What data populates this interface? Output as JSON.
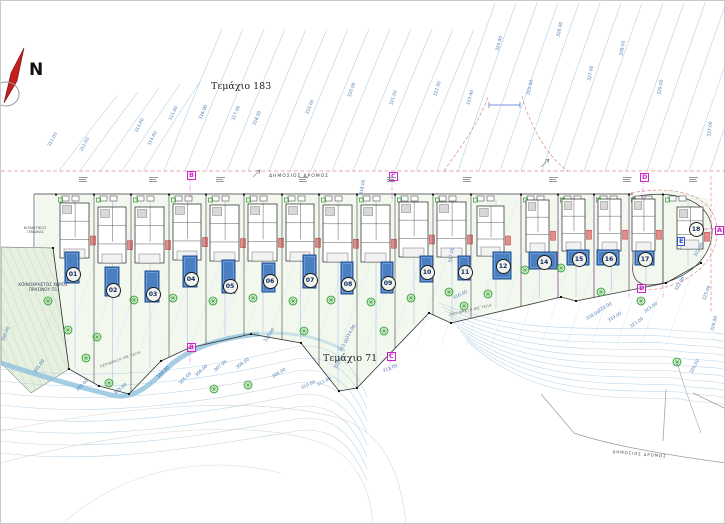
{
  "north_label": "N",
  "parcels": {
    "top": "Τεμάχιο 183",
    "bottom": "Τεμάχιο 71"
  },
  "roads": {
    "top": "ΔΗΜΟΣΙΟΣ ΔΡΟΜΟΣ",
    "bottom_right": "ΔΗΜΟΣΙΟΣ ΔΡΟΜΟΣ"
  },
  "notes": {
    "green_space_line1": "ΚΟΙΝΟΧΡΗΣΤΟΣ ΧΩΡΟΣ",
    "green_space_line2": "ΠΡΑΣΙΝΟΥ Π1",
    "hotel_line1": "ΚΟΙΝΟΤΙΚΟΣ",
    "hotel_line2": "ΞΕΝΩΝΑΣ"
  },
  "fence_labels": [
    {
      "text": "ΠΕΡΙΦΡΑΞΗ ΜΕ ΤΕΛΗ",
      "x": 120,
      "y": 366,
      "r": -20
    },
    {
      "text": "ΠΕΡΙΦΡΑΞΗ ΜΕ ΤΕΛΗ",
      "x": 470,
      "y": 314,
      "r": -13
    }
  ],
  "section_markers": [
    {
      "t": "B",
      "x": 186,
      "y": 170,
      "c": "#cc22cc"
    },
    {
      "t": "C",
      "x": 388,
      "y": 171,
      "c": "#cc22cc"
    },
    {
      "t": "D",
      "x": 639,
      "y": 172,
      "c": "#cc22cc"
    },
    {
      "t": "A",
      "x": 714,
      "y": 225,
      "c": "#cc22cc"
    },
    {
      "t": "E",
      "x": 676,
      "y": 236,
      "c": "#3355cc"
    },
    {
      "t": "D",
      "x": 636,
      "y": 283,
      "c": "#cc22cc"
    },
    {
      "t": "B",
      "x": 186,
      "y": 342,
      "c": "#cc22cc"
    },
    {
      "t": "C",
      "x": 386,
      "y": 351,
      "c": "#cc22cc"
    }
  ],
  "contour_labels": [
    [
      "311.00",
      54,
      147,
      -62
    ],
    [
      "312.00",
      86,
      152,
      -62
    ],
    [
      "313.00",
      141,
      133,
      -63
    ],
    [
      "314.00",
      154,
      146,
      -63
    ],
    [
      "315.00",
      175,
      121,
      -64
    ],
    [
      "316.00",
      205,
      120,
      -66
    ],
    [
      "317.00",
      238,
      121,
      -67
    ],
    [
      "318.00",
      259,
      126,
      -67
    ],
    [
      "319.00",
      312,
      115,
      -68
    ],
    [
      "320.00",
      354,
      98,
      -70
    ],
    [
      "321.00",
      396,
      106,
      -72
    ],
    [
      "322.00",
      440,
      97,
      -73
    ],
    [
      "323.00",
      473,
      106,
      -74
    ],
    [
      "324.00",
      502,
      52,
      -75
    ],
    [
      "325.00",
      533,
      96,
      -76
    ],
    [
      "326.00",
      563,
      38,
      -78
    ],
    [
      "327.00",
      594,
      82,
      -79
    ],
    [
      "328.00",
      626,
      57,
      -80
    ],
    [
      "329.00",
      664,
      96,
      -80
    ],
    [
      "327.00",
      714,
      138,
      -84
    ],
    [
      "318.00",
      366,
      196,
      -80
    ],
    [
      "317.00",
      455,
      264,
      -80
    ],
    [
      "310.00",
      270,
      342,
      -55
    ],
    [
      "310.00",
      307,
      388,
      -25
    ],
    [
      "311.00",
      323,
      385,
      -27
    ],
    [
      "311.00",
      389,
      371,
      -22
    ],
    [
      "312.00",
      340,
      369,
      -55
    ],
    [
      "313.00",
      345,
      352,
      -58
    ],
    [
      "314.00",
      352,
      339,
      -60
    ],
    [
      "304.00",
      163,
      378,
      -45
    ],
    [
      "305.00",
      185,
      384,
      -44
    ],
    [
      "306.00",
      201,
      376,
      -42
    ],
    [
      "307.00",
      220,
      371,
      -40
    ],
    [
      "308.00",
      242,
      368,
      -36
    ],
    [
      "309.00",
      278,
      377,
      -31
    ],
    [
      "300.00",
      8,
      342,
      -70
    ],
    [
      "301.00",
      40,
      373,
      -55
    ],
    [
      "302.00",
      82,
      391,
      -45
    ],
    [
      "303.00",
      120,
      394,
      -40
    ],
    [
      "316.00",
      459,
      298,
      -25
    ],
    [
      "318.00",
      592,
      319,
      -30
    ],
    [
      "319.00",
      614,
      321,
      -32
    ],
    [
      "320.00",
      604,
      311,
      -30
    ],
    [
      "321.00",
      636,
      327,
      -35
    ],
    [
      "323.00",
      650,
      312,
      -35
    ],
    [
      "322.00",
      681,
      291,
      -60
    ],
    [
      "325.00",
      709,
      301,
      -70
    ],
    [
      "320.00",
      696,
      374,
      -62
    ],
    [
      "326.00",
      717,
      332,
      -75
    ],
    [
      "322.00",
      700,
      257,
      -60
    ]
  ],
  "plots": [
    {
      "n": "01",
      "x0": 55,
      "x1": 93,
      "house": [
        59,
        202,
        29,
        55
      ],
      "pool": [
        64,
        251,
        14,
        31
      ],
      "circle": [
        71,
        272
      ]
    },
    {
      "n": "02",
      "x0": 93,
      "x1": 130,
      "house": [
        97,
        206,
        28,
        56
      ],
      "pool": [
        104,
        266,
        14,
        29
      ],
      "circle": [
        111,
        288
      ]
    },
    {
      "n": "03",
      "x0": 130,
      "x1": 168,
      "house": [
        134,
        206,
        29,
        56
      ],
      "pool": [
        144,
        270,
        14,
        31
      ],
      "circle": [
        151,
        292
      ]
    },
    {
      "n": "04",
      "x0": 168,
      "x1": 205,
      "house": [
        172,
        203,
        28,
        56
      ],
      "pool": [
        182,
        255,
        14,
        31
      ],
      "circle": [
        189,
        277
      ]
    },
    {
      "n": "05",
      "x0": 205,
      "x1": 243,
      "house": [
        209,
        204,
        29,
        56
      ],
      "pool": [
        221,
        259,
        13,
        33
      ],
      "circle": [
        228,
        284
      ]
    },
    {
      "n": "06",
      "x0": 243,
      "x1": 281,
      "house": [
        247,
        203,
        29,
        57
      ],
      "pool": [
        261,
        262,
        13,
        29
      ],
      "circle": [
        268,
        279
      ]
    },
    {
      "n": "07",
      "x0": 281,
      "x1": 318,
      "house": [
        285,
        203,
        28,
        57
      ],
      "pool": [
        302,
        254,
        13,
        33
      ],
      "circle": [
        308,
        278
      ]
    },
    {
      "n": "08",
      "x0": 318,
      "x1": 356,
      "house": [
        322,
        204,
        29,
        57
      ],
      "pool": [
        340,
        261,
        12,
        32
      ],
      "circle": [
        346,
        282
      ]
    },
    {
      "n": "09",
      "x0": 356,
      "x1": 394,
      "house": [
        360,
        204,
        29,
        57
      ],
      "pool": [
        380,
        261,
        12,
        31
      ],
      "circle": [
        386,
        281
      ]
    },
    {
      "n": "10",
      "x0": 394,
      "x1": 432,
      "house": [
        398,
        201,
        29,
        55
      ],
      "pool": [
        419,
        255,
        13,
        26
      ],
      "circle": [
        425,
        270
      ]
    },
    {
      "n": "11",
      "x0": 432,
      "x1": 470,
      "house": [
        436,
        201,
        29,
        55
      ],
      "pool": [
        457,
        255,
        12,
        24
      ],
      "circle": [
        463,
        270
      ]
    },
    {
      "n": "12",
      "x0": 470,
      "x1": 520,
      "house": [
        476,
        205,
        27,
        50
      ],
      "pool": [
        492,
        251,
        18,
        27
      ],
      "circle": [
        501,
        264
      ]
    },
    {
      "n": "14",
      "x0": 520,
      "x1": 557,
      "house": [
        525,
        199,
        23,
        52
      ],
      "pool": [
        528,
        251,
        28,
        17
      ],
      "circle": [
        542,
        260
      ]
    },
    {
      "n": "15",
      "x0": 557,
      "x1": 593,
      "house": [
        561,
        198,
        23,
        52
      ],
      "pool": [
        566,
        249,
        22,
        15
      ],
      "circle": [
        577,
        257
      ]
    },
    {
      "n": "16",
      "x0": 593,
      "x1": 628,
      "house": [
        597,
        198,
        23,
        52
      ],
      "pool": [
        596,
        249,
        22,
        15
      ],
      "circle": [
        607,
        257
      ]
    },
    {
      "n": "17",
      "x0": 628,
      "x1": 662,
      "house": [
        631,
        198,
        23,
        52
      ],
      "pool": [
        634,
        250,
        19,
        14
      ],
      "circle": [
        643,
        257
      ]
    },
    {
      "n": "18",
      "x0": 662,
      "x1": 712,
      "house": [
        676,
        206,
        26,
        42
      ],
      "pool": null,
      "circle": [
        694,
        227
      ]
    }
  ],
  "trees": [
    [
      47,
      300
    ],
    [
      67,
      329
    ],
    [
      85,
      357
    ],
    [
      108,
      382
    ],
    [
      133,
      299
    ],
    [
      172,
      297
    ],
    [
      212,
      300
    ],
    [
      252,
      297
    ],
    [
      292,
      300
    ],
    [
      330,
      299
    ],
    [
      370,
      301
    ],
    [
      410,
      297
    ],
    [
      448,
      291
    ],
    [
      487,
      293
    ],
    [
      524,
      269
    ],
    [
      560,
      267
    ],
    [
      600,
      291
    ],
    [
      640,
      300
    ],
    [
      676,
      361
    ],
    [
      213,
      388
    ],
    [
      247,
      384
    ],
    [
      96,
      336
    ],
    [
      303,
      330
    ],
    [
      383,
      330
    ],
    [
      463,
      305
    ]
  ],
  "colors": {
    "contour": "#a9c9e0",
    "contour_faint": "#cfe2ef",
    "contour_label": "#4a7ab5",
    "boundary_red": "#e08a8a",
    "magenta": "#cc22cc",
    "pool_fill": "#4a7fc1",
    "pool_border": "#1c4f93",
    "tree": "#2f9e2f",
    "green_fill": "#e6f0e0",
    "garden": "#f3f8ef",
    "stream": "#8fc0dc",
    "north_red": "#c41e1e"
  }
}
